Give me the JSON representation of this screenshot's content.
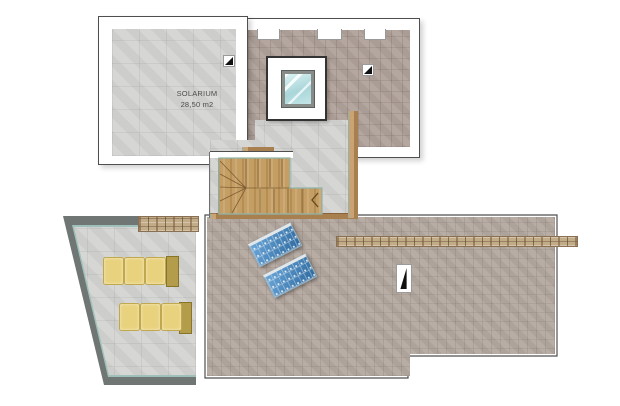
{
  "rooms": {
    "solarium": {
      "label": "SOLARIUM",
      "area_label": "28,50 m2"
    }
  },
  "features": {
    "skylight_count": 1,
    "solar_panel_count": 2,
    "sun_lounger_count": 2,
    "roof_drain_count": 3,
    "stone_wall_strip_count": 2,
    "staircase": "L-shaped winder stair with direction arrow"
  },
  "icons": {
    "skylight": "blue glass square in white frame",
    "roof_drain": "white square with black triangle",
    "solar_panel": "blue cell grid rectangle",
    "sun_lounger": "three yellow cushions with frame"
  },
  "colors": {
    "outline": "#4f4f4f",
    "gray-tile": "#d3d4d2",
    "roof-tile": "#b0a29a",
    "main-tile": "#b4a9a0",
    "wood": "#c59e63",
    "accent-teal": "#9fc0ba",
    "trim-tan": "#c09468",
    "stone-light": "#c2ab87",
    "stone-dark": "#8a7052",
    "wall-gray": "#6f7673",
    "glass-blue": "#a9d6da",
    "panel-blue": "#3f7ab8",
    "cushion-yellow": "#e9d27e",
    "lounger-frame": "#b39d4b"
  }
}
